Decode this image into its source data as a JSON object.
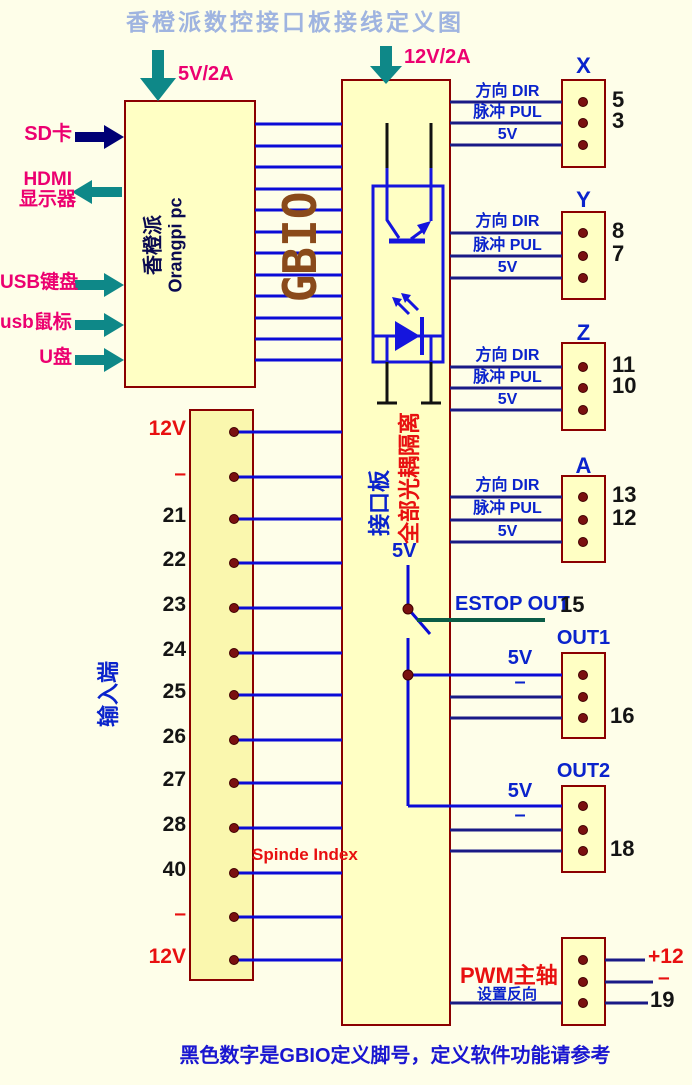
{
  "title": "香橙派数控接口板接线定义图",
  "power": {
    "left": "5V/2A",
    "right": "12V/2A"
  },
  "sbc": {
    "name_cn": "香橙派",
    "name_en": "Orangpi pc"
  },
  "bus_label": "GBIO",
  "peripherals": {
    "sd": "SD卡",
    "hdmi_line1": "HDMI",
    "hdmi_line2": "显示器",
    "usb_keyboard": "USB键盘",
    "usb_mouse": "usb鼠标",
    "udisk": "U盘"
  },
  "board": {
    "name": "接口板",
    "isolation": "全部光耦隔离",
    "rail_5v": "5V"
  },
  "axes": [
    {
      "name": "X",
      "sig_dir": "方向 DIR",
      "sig_pul": "脉冲 PUL",
      "sig_5v": "5V",
      "pin_dir": "5",
      "pin_pul": "3"
    },
    {
      "name": "Y",
      "sig_dir": "方向 DIR",
      "sig_pul": "脉冲 PUL",
      "sig_5v": "5V",
      "pin_dir": "8",
      "pin_pul": "7"
    },
    {
      "name": "Z",
      "sig_dir": "方向 DIR",
      "sig_pul": "脉冲 PUL",
      "sig_5v": "5V",
      "pin_dir": "11",
      "pin_pul": "10"
    },
    {
      "name": "A",
      "sig_dir": "方向 DIR",
      "sig_pul": "脉冲 PUL",
      "sig_5v": "5V",
      "pin_dir": "13",
      "pin_pul": "12"
    }
  ],
  "estop": {
    "label": "ESTOP OUT",
    "pin": "15"
  },
  "outputs": [
    {
      "name": "OUT1",
      "rail": "5V",
      "minus": "–",
      "pin": "16"
    },
    {
      "name": "OUT2",
      "rail": "5V",
      "minus": "–",
      "pin": "18"
    }
  ],
  "pwm": {
    "title": "PWM主轴",
    "subtitle": "设置反向",
    "pin_plus": "+12",
    "pin_minus": "–",
    "pin_num": "19"
  },
  "input_block": {
    "side_label": "输入端",
    "annotation": "Spinde Index",
    "pins": [
      {
        "label": "12V"
      },
      {
        "label": "–"
      },
      {
        "label": "21"
      },
      {
        "label": "22"
      },
      {
        "label": "23"
      },
      {
        "label": "24"
      },
      {
        "label": "25"
      },
      {
        "label": "26"
      },
      {
        "label": "27"
      },
      {
        "label": "28"
      },
      {
        "label": "40"
      },
      {
        "label": "–"
      },
      {
        "label": "12V"
      }
    ]
  },
  "footer": "黑色数字是GBIO定义脚号，定义软件功能请参考",
  "colors": {
    "background": "#FEFEE9",
    "box_fill": "#FFFFC4",
    "box_border": "#8B0000",
    "wire_blue": "#0B0BD6",
    "wire_navy": "#1A1A86",
    "estop_wire": "#0A5C46",
    "teal_arrow": "#0E8888",
    "navy_arrow": "#000075",
    "magenta": "#EC0070",
    "red_text": "#E81010",
    "blue_text": "#0A23CC",
    "brown_text": "#8A4A1A",
    "title_text": "#9FB4E0"
  }
}
